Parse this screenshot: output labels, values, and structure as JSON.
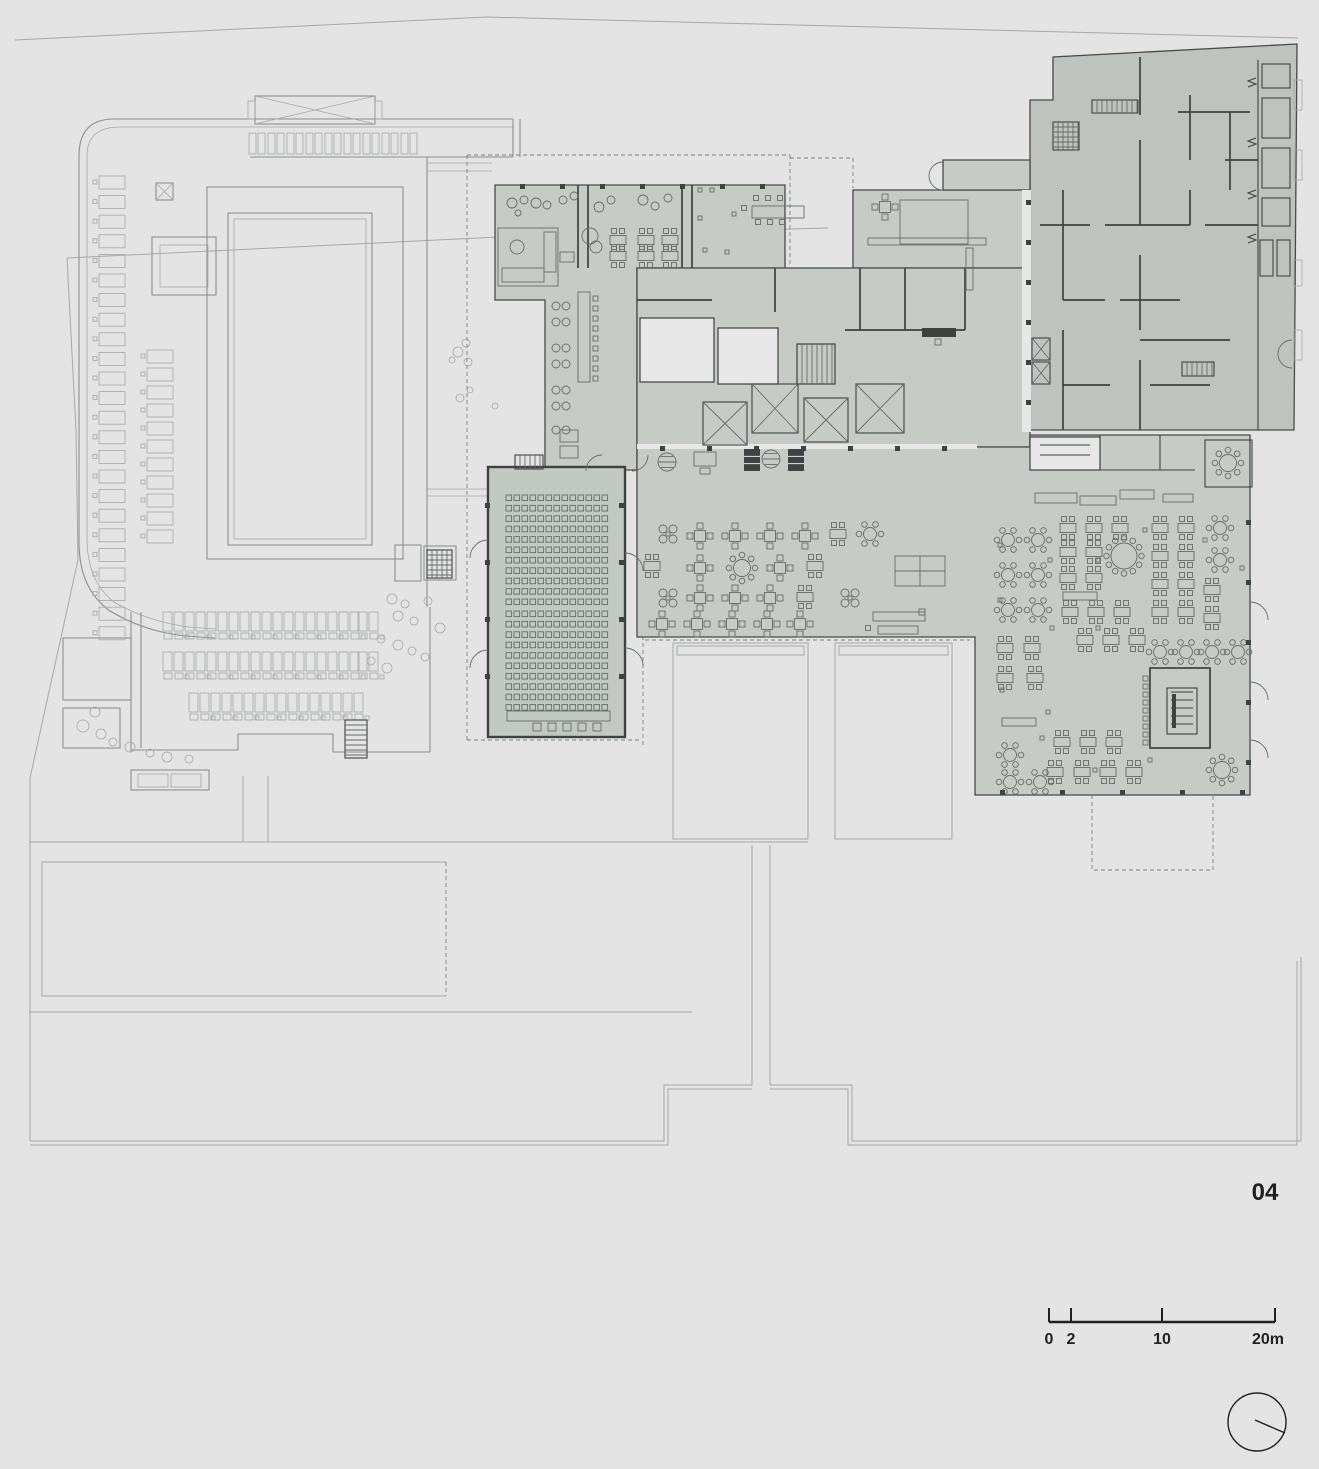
{
  "annotations": {
    "sheet_number": "04",
    "scale_bar": {
      "labels": [
        "0",
        "2",
        "10",
        "20m"
      ]
    }
  },
  "colors": {
    "bg": "#e3e4e3",
    "site": "#a6a9a7",
    "ctx": "#8d918f",
    "dash": "#7c817f",
    "fillA": "#c6cbc5",
    "fillB": "#bfc3c0",
    "fillAud": "#c2c8c2",
    "edge": "#474b49",
    "wall": "#3e4240",
    "white": "#e6e7e6",
    "furn": "#676c6a",
    "text": "#1f2220"
  },
  "plan": {
    "auditorium_seats": [
      {
        "x0": 506,
        "y0": 495,
        "cols": 13,
        "dx": 8,
        "rows": 11,
        "dy": 10.4,
        "w": 5.6,
        "h": 5.6
      },
      {
        "x0": 506,
        "y0": 611,
        "cols": 13,
        "dx": 8,
        "rows": 10,
        "dy": 10.4,
        "w": 5.6,
        "h": 5.6
      }
    ],
    "aud_front_squares": {
      "y": 723,
      "xs": [
        533,
        548,
        563,
        578,
        593
      ],
      "s": 8
    },
    "stall_columns": [
      {
        "x": 99,
        "y0": 176,
        "n": 24,
        "dy": 19.6,
        "w": 26,
        "h": 13
      },
      {
        "x": 147,
        "y0": 350,
        "n": 11,
        "dy": 18,
        "w": 26,
        "h": 13
      }
    ],
    "stall_row": {
      "x0": 249,
      "y": 133,
      "n": 9,
      "dx": 19,
      "w": 7,
      "h": 21
    },
    "left_table_rows": [
      {
        "y": 612,
        "xs": [
          163,
          185,
          207,
          229,
          251,
          273,
          295,
          317,
          339,
          358
        ]
      },
      {
        "y": 652,
        "xs": [
          163,
          185,
          207,
          229,
          251,
          273,
          295,
          317,
          339,
          358
        ]
      },
      {
        "y": 693,
        "xs": [
          189,
          211,
          233,
          255,
          277,
          299,
          321,
          343
        ]
      }
    ],
    "trees": [
      [
        95,
        712,
        5
      ],
      [
        83,
        726,
        6
      ],
      [
        101,
        734,
        5
      ],
      [
        113,
        742,
        4
      ],
      [
        130,
        747,
        5
      ],
      [
        150,
        753,
        4
      ],
      [
        167,
        757,
        5
      ],
      [
        189,
        759,
        4
      ],
      [
        392,
        599,
        5
      ],
      [
        405,
        604,
        4
      ],
      [
        398,
        616,
        5
      ],
      [
        414,
        621,
        4
      ],
      [
        381,
        639,
        4
      ],
      [
        398,
        645,
        5
      ],
      [
        412,
        651,
        4
      ],
      [
        371,
        661,
        4
      ],
      [
        387,
        668,
        5
      ],
      [
        425,
        657,
        4
      ],
      [
        440,
        628,
        5
      ],
      [
        428,
        601,
        4
      ],
      [
        466,
        343,
        4
      ],
      [
        458,
        352,
        5
      ],
      [
        468,
        362,
        4
      ],
      [
        452,
        360,
        3
      ],
      [
        470,
        390,
        3
      ],
      [
        460,
        398,
        4
      ],
      [
        495,
        406,
        3
      ]
    ],
    "wall_columns": [
      [
        485,
        503
      ],
      [
        485,
        560
      ],
      [
        485,
        617
      ],
      [
        485,
        674
      ],
      [
        619,
        503
      ],
      [
        619,
        560
      ],
      [
        619,
        617
      ],
      [
        619,
        674
      ],
      [
        660,
        446
      ],
      [
        707,
        446
      ],
      [
        754,
        446
      ],
      [
        801,
        446
      ],
      [
        848,
        446
      ],
      [
        895,
        446
      ],
      [
        942,
        446
      ],
      [
        520,
        184
      ],
      [
        560,
        184
      ],
      [
        600,
        184
      ],
      [
        640,
        184
      ],
      [
        680,
        184
      ],
      [
        720,
        184
      ],
      [
        760,
        184
      ],
      [
        1026,
        200
      ],
      [
        1026,
        240
      ],
      [
        1026,
        280
      ],
      [
        1026,
        320
      ],
      [
        1026,
        360
      ],
      [
        1026,
        400
      ],
      [
        1000,
        790
      ],
      [
        1060,
        790
      ],
      [
        1120,
        790
      ],
      [
        1180,
        790
      ],
      [
        1240,
        790
      ],
      [
        1246,
        520
      ],
      [
        1246,
        580
      ],
      [
        1246,
        640
      ],
      [
        1246,
        700
      ],
      [
        1246,
        760
      ]
    ],
    "furniture": [
      [
        "circ",
        512,
        203,
        5
      ],
      [
        "circ",
        524,
        200,
        4
      ],
      [
        "circ",
        536,
        203,
        5
      ],
      [
        "circ",
        518,
        213,
        3
      ],
      [
        "circ",
        547,
        205,
        4
      ],
      [
        "lrect",
        498,
        228,
        60,
        58
      ],
      [
        "lrect",
        502,
        268,
        42,
        14
      ],
      [
        "lrect",
        544,
        232,
        12,
        40
      ],
      [
        "circ",
        517,
        247,
        7
      ],
      [
        "lrect",
        560,
        252,
        14,
        10
      ],
      [
        "circ",
        563,
        200,
        4
      ],
      [
        "circ",
        574,
        196,
        4
      ],
      [
        "circ",
        599,
        207,
        5
      ],
      [
        "circ",
        611,
        200,
        4
      ],
      [
        "circ",
        643,
        200,
        5
      ],
      [
        "circ",
        655,
        206,
        4
      ],
      [
        "circ",
        668,
        198,
        4
      ],
      [
        "circ",
        590,
        236,
        8
      ],
      [
        "circ",
        596,
        247,
        6
      ],
      [
        "t2",
        618,
        240
      ],
      [
        "t2",
        646,
        240
      ],
      [
        "t2",
        670,
        240
      ],
      [
        "t2",
        618,
        256
      ],
      [
        "t2",
        646,
        256
      ],
      [
        "t2",
        670,
        256
      ],
      [
        "lrect",
        752,
        206,
        52,
        12
      ],
      [
        "sq",
        756,
        198,
        5
      ],
      [
        "sq",
        768,
        198,
        5
      ],
      [
        "sq",
        780,
        198,
        5
      ],
      [
        "sq",
        758,
        222,
        5
      ],
      [
        "sq",
        770,
        222,
        5
      ],
      [
        "sq",
        782,
        222,
        5
      ],
      [
        "sq",
        744,
        208,
        5
      ],
      [
        "sq",
        700,
        190,
        4
      ],
      [
        "sq",
        712,
        190,
        4
      ],
      [
        "sq",
        700,
        218,
        4
      ],
      [
        "sq",
        734,
        214,
        4
      ],
      [
        "sq",
        705,
        250,
        4
      ],
      [
        "sq",
        727,
        252,
        4
      ],
      [
        "t4",
        885,
        207
      ],
      [
        "lrect",
        868,
        238,
        118,
        7
      ],
      [
        "lrect",
        900,
        200,
        68,
        44
      ],
      [
        "drect",
        922,
        328,
        34,
        9
      ],
      [
        "sq",
        938,
        342,
        6
      ],
      [
        "lrect",
        966,
        248,
        7,
        42
      ],
      [
        "circ",
        556,
        306,
        4
      ],
      [
        "circ",
        566,
        306,
        4
      ],
      [
        "circ",
        556,
        322,
        4
      ],
      [
        "circ",
        566,
        322,
        4
      ],
      [
        "circ",
        556,
        348,
        4
      ],
      [
        "circ",
        566,
        348,
        4
      ],
      [
        "circ",
        556,
        364,
        4
      ],
      [
        "circ",
        566,
        364,
        4
      ],
      [
        "circ",
        556,
        390,
        4
      ],
      [
        "circ",
        566,
        390,
        4
      ],
      [
        "circ",
        556,
        406,
        4
      ],
      [
        "circ",
        566,
        406,
        4
      ],
      [
        "circ",
        556,
        430,
        4
      ],
      [
        "circ",
        566,
        430,
        4
      ],
      [
        "bar",
        578,
        292,
        12,
        90
      ],
      [
        "lrect",
        560,
        430,
        18,
        12
      ],
      [
        "lrect",
        560,
        446,
        18,
        12
      ],
      [
        "grill",
        744,
        449,
        16,
        22
      ],
      [
        "hcircle",
        771,
        459,
        9
      ],
      [
        "grill",
        788,
        449,
        16,
        22
      ],
      [
        "hcircle",
        667,
        462,
        9
      ],
      [
        "lrect",
        694,
        452,
        22,
        14
      ],
      [
        "lrect",
        700,
        468,
        10,
        6
      ],
      [
        "x4",
        668,
        534
      ],
      [
        "t4",
        700,
        536
      ],
      [
        "t4",
        735,
        536
      ],
      [
        "t4",
        770,
        536
      ],
      [
        "t4",
        805,
        536
      ],
      [
        "t2",
        838,
        534
      ],
      [
        "r6",
        870,
        534
      ],
      [
        "t2",
        652,
        566
      ],
      [
        "t4",
        700,
        568
      ],
      [
        "r8",
        742,
        568
      ],
      [
        "t4",
        780,
        568
      ],
      [
        "t2",
        815,
        566
      ],
      [
        "sofa",
        895,
        556,
        50,
        30
      ],
      [
        "x4",
        668,
        598
      ],
      [
        "t4",
        700,
        598
      ],
      [
        "t4",
        735,
        598
      ],
      [
        "t4",
        770,
        598
      ],
      [
        "t2",
        805,
        597
      ],
      [
        "x4",
        850,
        598
      ],
      [
        "t4",
        662,
        624
      ],
      [
        "t4",
        697,
        624
      ],
      [
        "t4",
        732,
        624
      ],
      [
        "t4",
        767,
        624
      ],
      [
        "t4",
        800,
        624
      ],
      [
        "lrect",
        873,
        612,
        52,
        9
      ],
      [
        "lrect",
        878,
        626,
        40,
        8
      ],
      [
        "sq",
        922,
        612,
        6
      ],
      [
        "sq",
        868,
        628,
        5
      ],
      [
        "lrect",
        1035,
        493,
        42,
        10
      ],
      [
        "lrect",
        1080,
        496,
        36,
        9
      ],
      [
        "lrect",
        1120,
        490,
        34,
        9
      ],
      [
        "lrect",
        1163,
        494,
        30,
        8
      ],
      [
        "r8",
        1228,
        463
      ],
      [
        "r6",
        1008,
        540
      ],
      [
        "r6",
        1038,
        540
      ],
      [
        "r6",
        1008,
        575
      ],
      [
        "r6",
        1038,
        575
      ],
      [
        "r6",
        1008,
        610
      ],
      [
        "r6",
        1038,
        610
      ],
      [
        "t2",
        1005,
        648
      ],
      [
        "t2",
        1032,
        648
      ],
      [
        "t2",
        1005,
        678
      ],
      [
        "t2",
        1035,
        678
      ],
      [
        "lrect",
        1002,
        718,
        34,
        8
      ],
      [
        "r6",
        1010,
        755
      ],
      [
        "r6",
        1040,
        782
      ],
      [
        "r6",
        1010,
        782
      ],
      [
        "t2",
        1068,
        528
      ],
      [
        "t2",
        1094,
        528
      ],
      [
        "t2",
        1120,
        528
      ],
      [
        "t2",
        1068,
        552
      ],
      [
        "t2",
        1094,
        552
      ],
      [
        "t2",
        1068,
        578
      ],
      [
        "t2",
        1094,
        578
      ],
      [
        "r12",
        1124,
        556
      ],
      [
        "lrect",
        1063,
        592,
        34,
        8
      ],
      [
        "t2",
        1070,
        612
      ],
      [
        "t2",
        1096,
        612
      ],
      [
        "t2",
        1122,
        612
      ],
      [
        "t2",
        1085,
        640
      ],
      [
        "t2",
        1111,
        640
      ],
      [
        "t2",
        1137,
        640
      ],
      [
        "t2",
        1160,
        528
      ],
      [
        "t2",
        1186,
        528
      ],
      [
        "t2",
        1160,
        556
      ],
      [
        "t2",
        1186,
        556
      ],
      [
        "t2",
        1160,
        584
      ],
      [
        "t2",
        1186,
        584
      ],
      [
        "t2",
        1160,
        612
      ],
      [
        "t2",
        1186,
        612
      ],
      [
        "r6",
        1220,
        528
      ],
      [
        "r6",
        1220,
        560
      ],
      [
        "t2",
        1212,
        590
      ],
      [
        "t2",
        1212,
        618
      ],
      [
        "r6",
        1160,
        652
      ],
      [
        "r6",
        1186,
        652
      ],
      [
        "r6",
        1212,
        652
      ],
      [
        "r6",
        1238,
        652
      ],
      [
        "t2",
        1062,
        742
      ],
      [
        "t2",
        1088,
        742
      ],
      [
        "t2",
        1114,
        742
      ],
      [
        "t2",
        1055,
        772
      ],
      [
        "t2",
        1082,
        772
      ],
      [
        "t2",
        1108,
        772
      ],
      [
        "t2",
        1134,
        772
      ],
      [
        "r8",
        1222,
        770
      ],
      [
        "sq",
        1000,
        545,
        4
      ],
      [
        "sq",
        1050,
        560,
        4
      ],
      [
        "sq",
        1000,
        600,
        4
      ],
      [
        "sq",
        1052,
        628,
        4
      ],
      [
        "sq",
        1098,
        560,
        4
      ],
      [
        "sq",
        1145,
        530,
        4
      ],
      [
        "sq",
        1098,
        628,
        4
      ],
      [
        "sq",
        1205,
        540,
        4
      ],
      [
        "sq",
        1242,
        568,
        4
      ],
      [
        "sq",
        1002,
        690,
        4
      ],
      [
        "sq",
        1048,
        712,
        4
      ],
      [
        "sq",
        1150,
        760,
        4
      ],
      [
        "sq",
        1095,
        770,
        4
      ],
      [
        "sq",
        1042,
        738,
        4
      ],
      [
        "seatcol",
        1143,
        676,
        9,
        8
      ],
      [
        "xbox",
        703,
        402,
        44,
        43
      ],
      [
        "xbox",
        752,
        384,
        46,
        49
      ],
      [
        "xbox",
        804,
        398,
        44,
        44
      ],
      [
        "xbox",
        856,
        384,
        48,
        49
      ],
      [
        "xbox",
        1032,
        338,
        18,
        22
      ],
      [
        "xbox",
        1032,
        362,
        18,
        22
      ],
      [
        "hatchV",
        797,
        344,
        38,
        40
      ],
      [
        "hatchG",
        1053,
        122,
        26,
        28
      ],
      [
        "hatchV",
        1092,
        100,
        46,
        13
      ],
      [
        "hatchV",
        1182,
        362,
        32,
        14
      ],
      [
        "hatchV",
        515,
        455,
        28,
        14
      ],
      [
        "hatchG",
        427,
        550,
        25,
        28
      ],
      [
        "hatchH",
        345,
        720,
        22,
        38
      ]
    ]
  }
}
